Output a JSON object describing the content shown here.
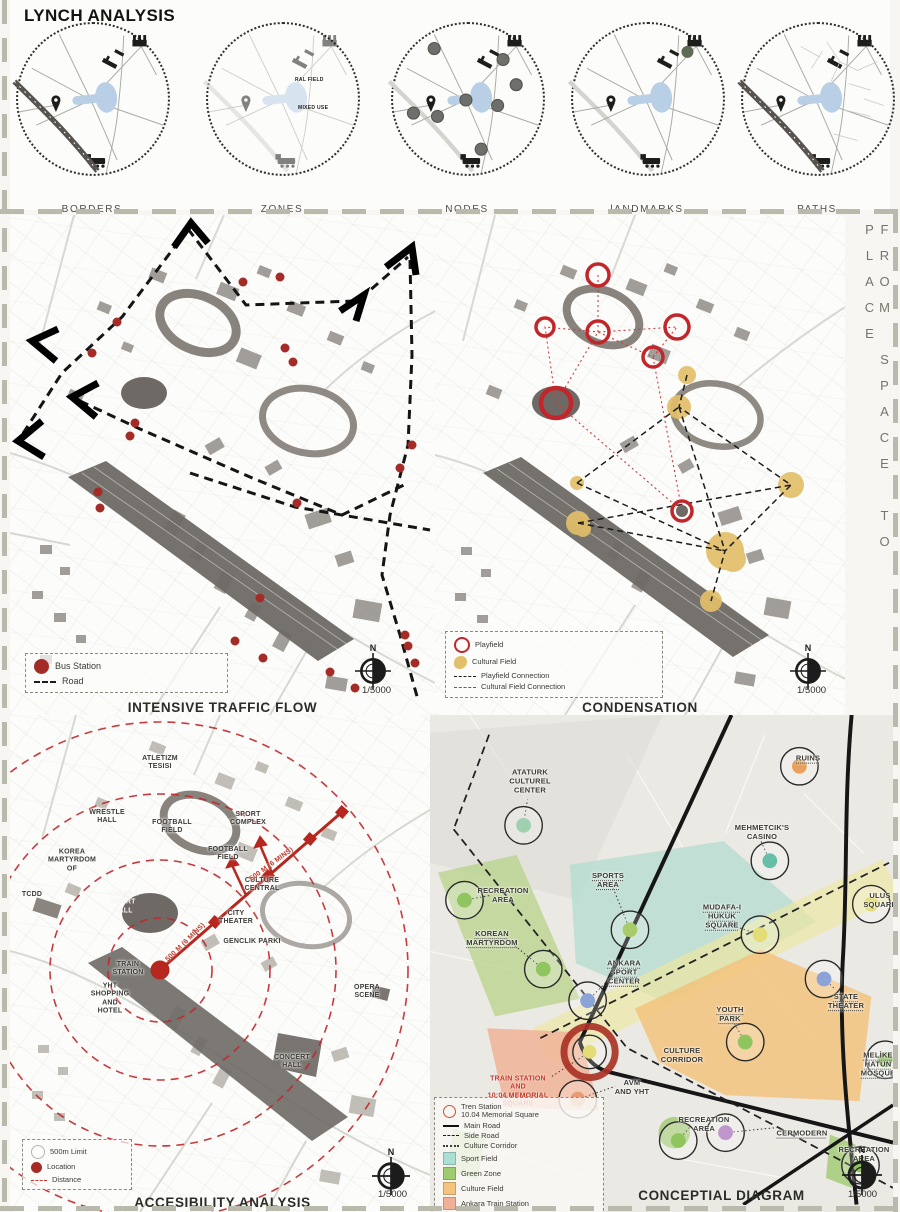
{
  "lynch": {
    "title": "LYNCH ANALYSIS",
    "diagrams": [
      {
        "label": "BORDERS"
      },
      {
        "label": "ZONES",
        "zone_labels": [
          "RAL FIELD",
          "MIXED USE"
        ]
      },
      {
        "label": "NODES"
      },
      {
        "label": "lANDMARKS"
      },
      {
        "label": "PATHS"
      }
    ]
  },
  "side_text": "FROM SPACE TO PLACE",
  "maps": {
    "traffic": {
      "title": "INTENSIVE TRAFFIC FLOW",
      "legend": {
        "bus_station": "Bus Station",
        "road": "Road"
      },
      "scale": "1/5000",
      "north": "N"
    },
    "condensation": {
      "title": "CONDENSATION",
      "legend": {
        "playfield": "Playfield",
        "cultural_field": "Cultural Field",
        "playfield_connection": "Playfield Connection",
        "cultural_field_connection": "Cultural Field Connection"
      },
      "scale": "1/5000",
      "north": "N"
    },
    "accessibility": {
      "title": "ACCESIBILITY ANALYSIS",
      "legend": {
        "limit": "500m Limit",
        "location": "Location",
        "distance": "Distance"
      },
      "scale": "1/5000",
      "north": "N",
      "labels": [
        "ATLETIZM\nTESISI",
        "WRESTLE\nHALL",
        "FOOTBALL\nFIELD",
        "SPORT\nCOMPLEX",
        "FOOTBALL\nFIELD",
        "KOREA\nMARTYRDOM\nOF",
        "CULTURE\nCENTRAL",
        "TCDD",
        "ANKARA\nSPORT\nHALL",
        "CITY\nTHEATER",
        "GENCLIK PARKI",
        "TRAIN\nSTATION",
        "YHT\nSHOPPING\nAND\nHOTEL",
        "OPERA\nSCENE",
        "CONCERT\nHALL"
      ],
      "distance_labels": [
        "500 M (6 MINS)",
        "500 M (6 MINS)"
      ]
    },
    "conceptual": {
      "title": "CONCEPTIAL DIAGRAM",
      "scale": "1/5000",
      "north": "N",
      "labels": [
        "ATATURK\nCULTUREL\nCENTER",
        "RUINS",
        "MEHMETCIK'S\nCASINO",
        "ULUS\nSQUARE",
        "RECREATION\nAREA",
        "KOREAN\nMARTYRDOM",
        "SPORTS\nAREA",
        "MUDAFA-I\nHUKUK\nSQUARE",
        "ANKARA\nSPORT\nCENTER",
        "STATE\nTHEATER",
        "YOUTH\nPARK",
        "CULTURE\nCORRIDOR",
        "MELİKE\nHATUN\nMOSQUE",
        "TRAIN STATION\nAND\n10:04 MEMORIAL\nSQUARE",
        "AVM\nAND YHT",
        "RECREATION\nAREA",
        "CERMODERN",
        "RECREATION\nAREA"
      ],
      "legend": {
        "tren_station": "Tren Station",
        "memorial": "10.04 Memorial Square",
        "main_road": "Main Road",
        "side_road": "Side Road",
        "culture_corridor": "Culture Corridor",
        "sport_field": "Sport Field",
        "green_zone": "Green Zone",
        "culture_field": "Culture Field",
        "train_station": "Ankara Train Station",
        "mixed_use": "Mixed Use Field"
      }
    }
  },
  "colors": {
    "accent_red": "#c0272d",
    "playfield_red": "#c2262b",
    "cultural_yellow": "#e2bf69",
    "sport_teal": "#b7ddd1",
    "green_zone": "#9fcb6f",
    "culture_orange": "#f3c47f",
    "train_salmon": "#f0b49a",
    "corridor_yellow": "#efe6a0",
    "mixed_gray": "#dad8d3",
    "building_gray": "#8b8681",
    "lake_blue": "#b9cfe6"
  }
}
